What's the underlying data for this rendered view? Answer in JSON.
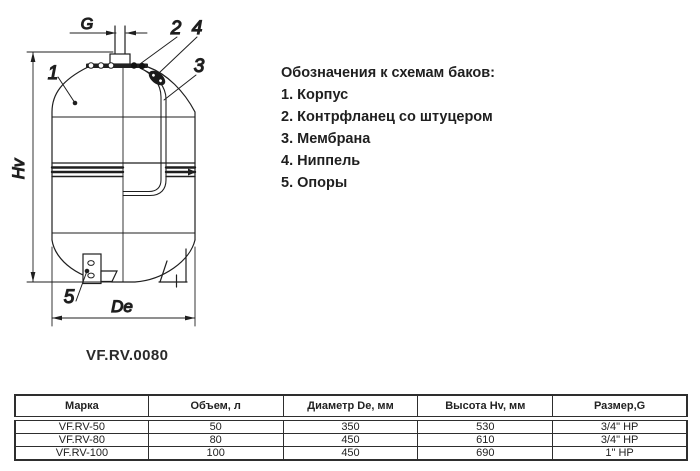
{
  "drawing": {
    "model_label": "VF.RV.0080",
    "labels": {
      "g": "G",
      "hv": "Hv",
      "de": "De",
      "n1": "1",
      "n2": "2",
      "n3": "3",
      "n4": "4",
      "n5": "5"
    }
  },
  "legend": {
    "title": "Обозначения к схемам баков:",
    "items": [
      "1. Корпус",
      "2. Контрфланец со штуцером",
      "3. Мембрана",
      "4. Ниппель",
      "5. Опоры"
    ]
  },
  "table": {
    "headers": [
      "Марка",
      "Объем, л",
      "Диаметр De, мм",
      "Высота Hv, мм",
      "Размер,G"
    ],
    "rows": [
      [
        "VF.RV-50",
        "50",
        "350",
        "530",
        "3/4\" НР"
      ],
      [
        "VF.RV-80",
        "80",
        "450",
        "610",
        "3/4\" НР"
      ],
      [
        "VF.RV-100",
        "100",
        "450",
        "690",
        "1\" НР"
      ]
    ]
  },
  "colors": {
    "line": "#1f1f1f",
    "table_border": "#2e2e2e",
    "background": "#ffffff"
  }
}
